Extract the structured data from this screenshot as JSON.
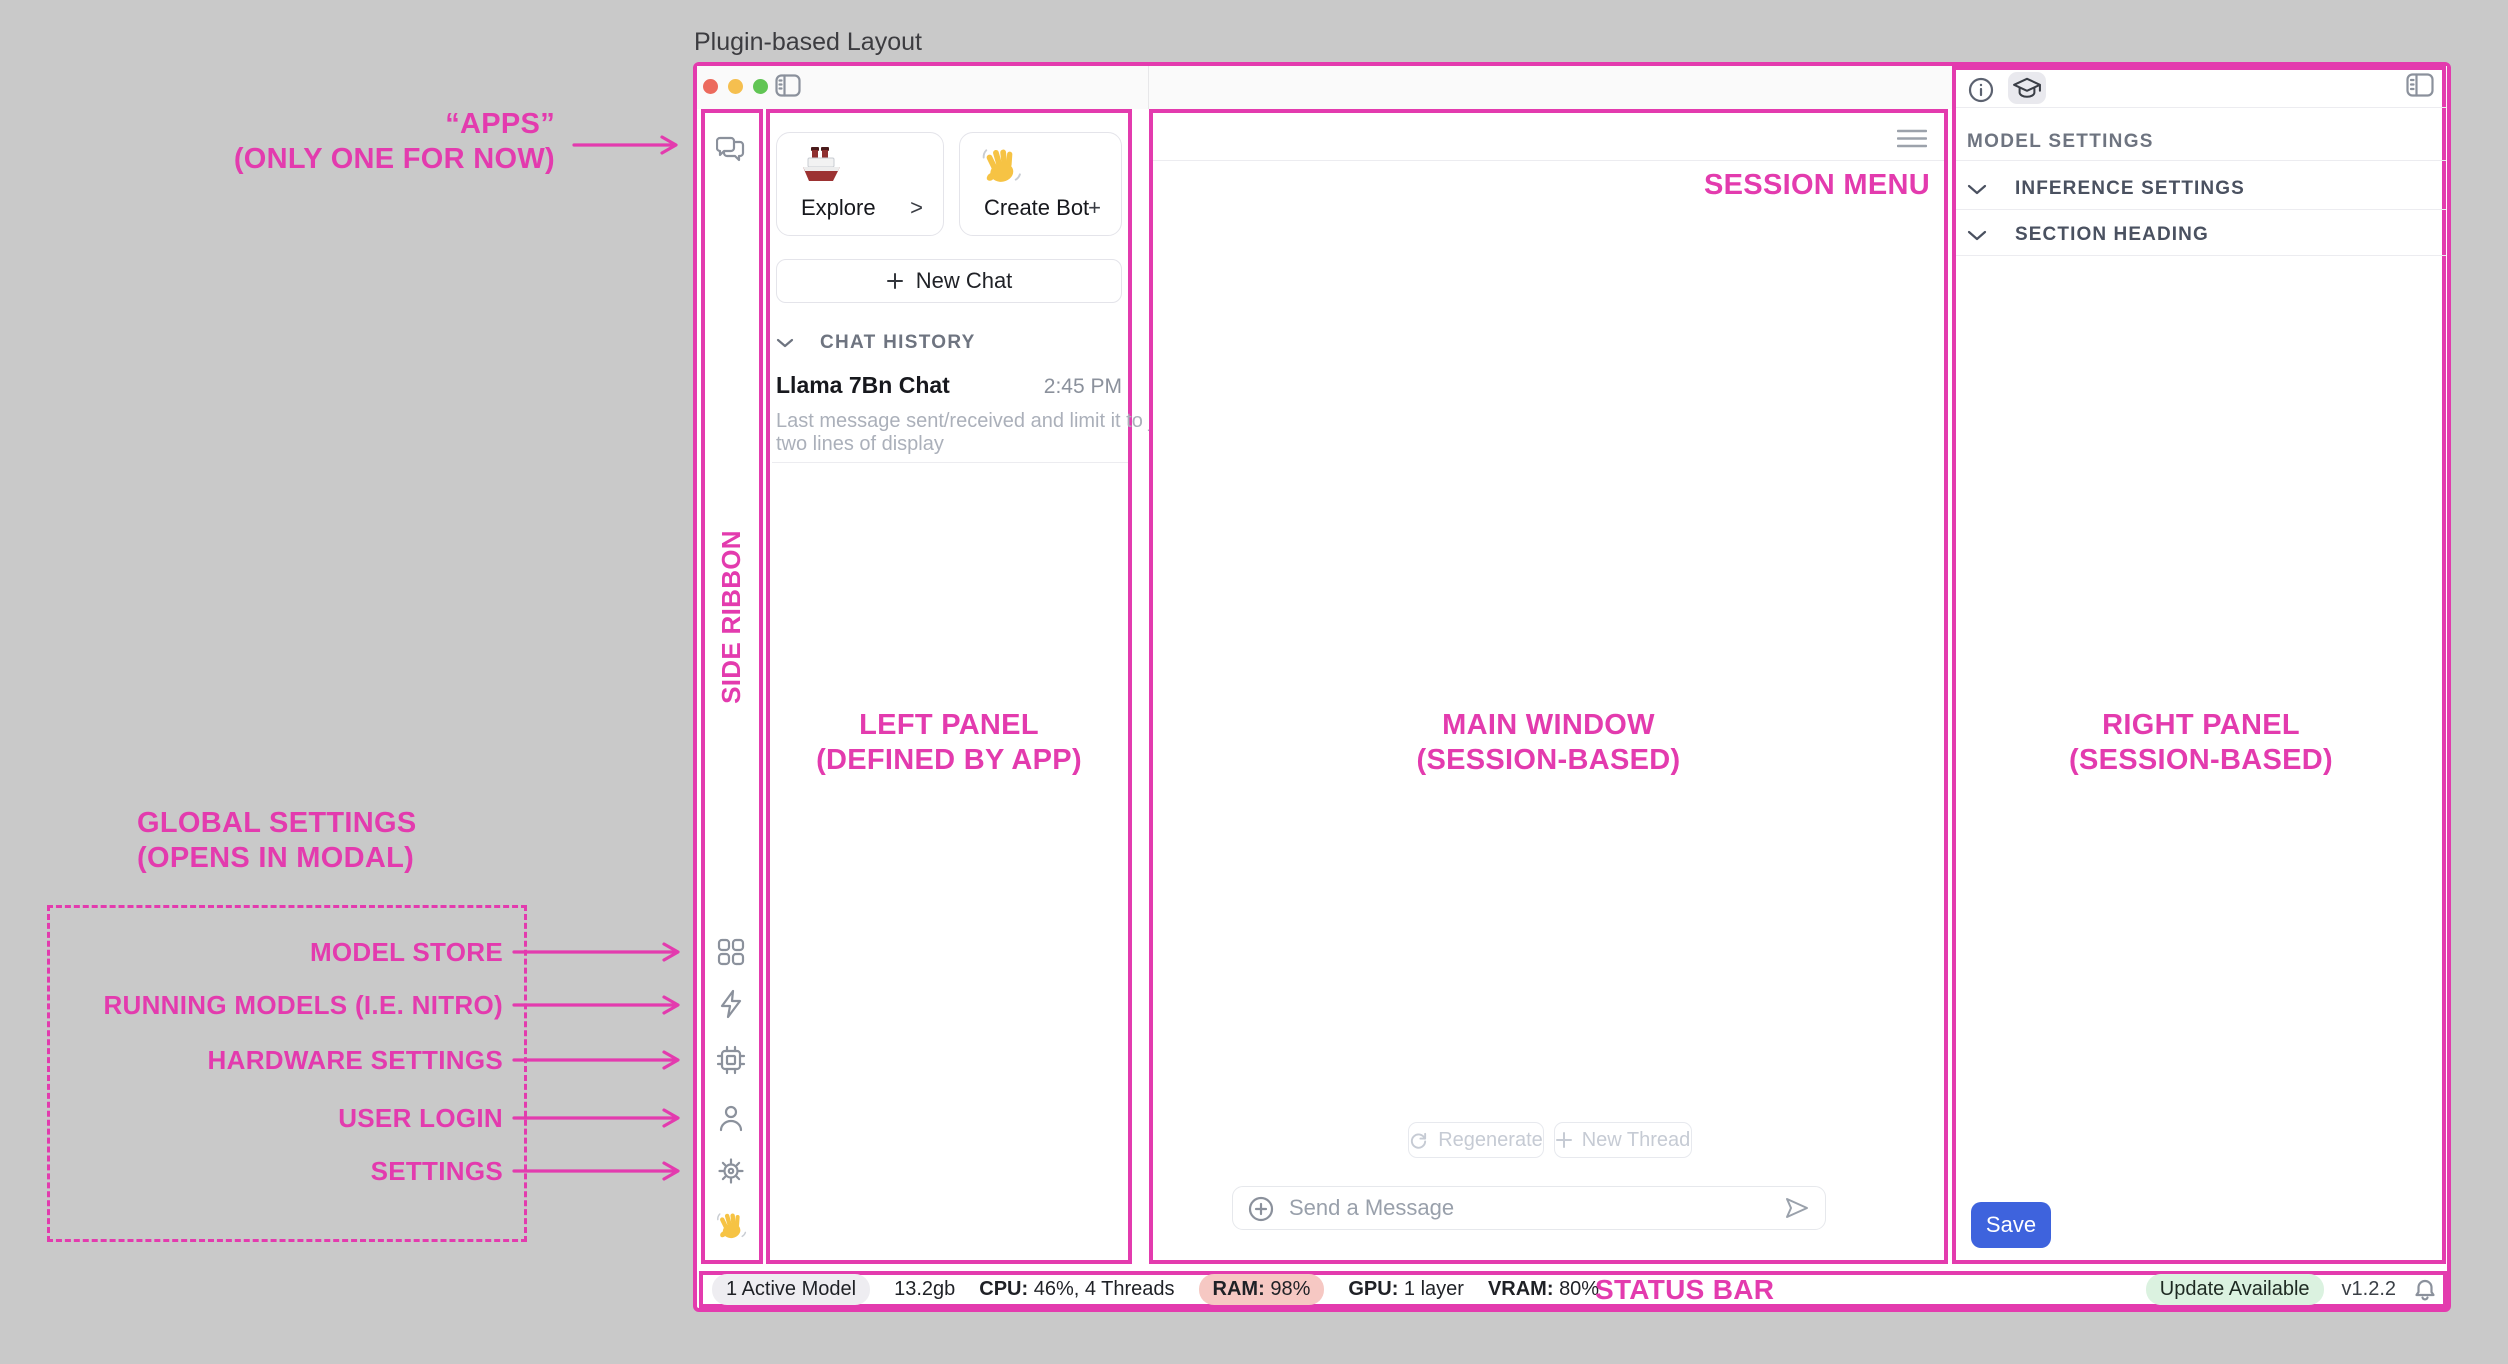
{
  "page": {
    "title": "Plugin-based Layout"
  },
  "annotations": {
    "accent_color": "#E33BAE",
    "apps_line1": "“APPS”",
    "apps_line2": "(ONLY ONE FOR NOW)",
    "side_ribbon": "SIDE RIBBON",
    "left_panel_line1": "LEFT PANEL",
    "left_panel_line2": "(DEFINED BY APP)",
    "main_window_line1": "MAIN WINDOW",
    "main_window_line2": "(SESSION-BASED)",
    "right_panel_line1": "RIGHT PANEL",
    "right_panel_line2": "(SESSION-BASED)",
    "session_menu": "SESSION MENU",
    "status_bar": "STATUS BAR",
    "global_settings_line1": "GLOBAL SETTINGS",
    "global_settings_line2": "(OPENS IN MODAL)",
    "global_items": [
      "MODEL STORE",
      "RUNNING MODELS (I.E. NITRO)",
      "HARDWARE SETTINGS",
      "USER LOGIN",
      "SETTINGS"
    ]
  },
  "side_ribbon": {
    "top_icons": [
      "chat-bubbles-icon"
    ],
    "bottom_icons": [
      "grid-icon",
      "lightning-icon",
      "chip-icon",
      "user-icon",
      "gear-icon",
      "wave-emoji"
    ]
  },
  "left_panel": {
    "explore": {
      "label": "Explore",
      "affordance": ">",
      "icon": "ship-emoji"
    },
    "create_bot": {
      "label": "Create Bot",
      "affordance": "+",
      "icon": "wave-emoji"
    },
    "new_chat_label": "New Chat",
    "chat_history_label": "CHAT HISTORY",
    "chat": {
      "title": "Llama 7Bn Chat",
      "time": "2:45 PM",
      "preview_line1": "Last message sent/received and limit it to just",
      "preview_line2": "two lines of display"
    }
  },
  "main_window": {
    "regenerate_label": "Regenerate",
    "new_thread_label": "New Thread",
    "message_placeholder": "Send a Message"
  },
  "right_panel": {
    "section_title": "MODEL SETTINGS",
    "rows": [
      {
        "label": "INFERENCE SETTINGS"
      },
      {
        "label": "SECTION HEADING"
      }
    ],
    "save_label": "Save"
  },
  "status_bar": {
    "active_model": "1 Active Model",
    "memory": "13.2gb",
    "cpu_label": "CPU:",
    "cpu_value": "46%, 4 Threads",
    "ram_label": "RAM:",
    "ram_value": "98%",
    "gpu_label": "GPU:",
    "gpu_value": "1 layer",
    "vram_label": "VRAM:",
    "vram_value": "80%",
    "update_badge": "Update Available",
    "version": "v1.2.2"
  }
}
